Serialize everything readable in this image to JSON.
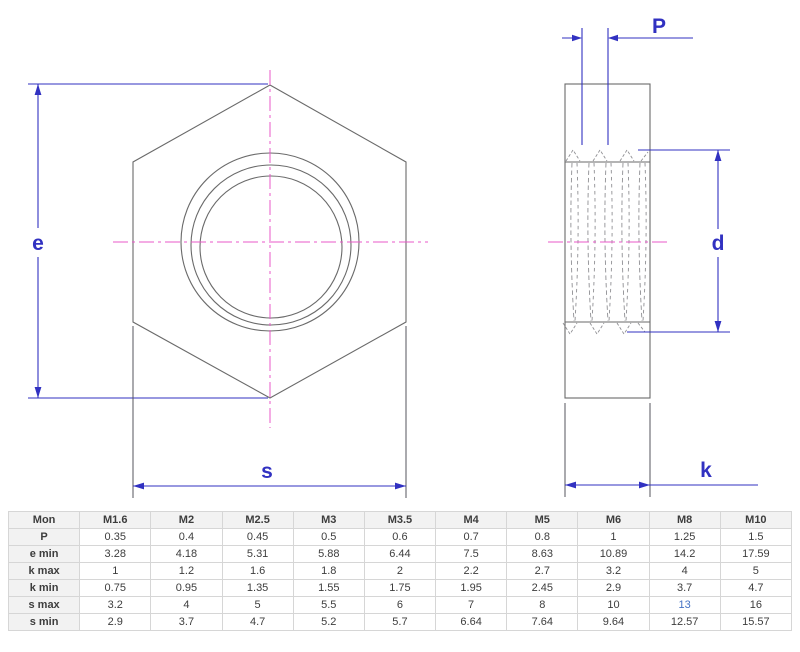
{
  "drawing": {
    "labels": {
      "e": "e",
      "s": "s",
      "P": "P",
      "d": "d",
      "k": "k"
    },
    "colors": {
      "dimension": "#3131c1",
      "centerline": "#e858c8",
      "outline": "#6a6a6a",
      "extension": "#55555e",
      "thread": "#8f8f93",
      "highlight": "#4472c4"
    }
  },
  "table": {
    "header": [
      "Mon",
      "M1.6",
      "M2",
      "M2.5",
      "M3",
      "M3.5",
      "M4",
      "M5",
      "M6",
      "M8",
      "M10"
    ],
    "rows": [
      {
        "label": "P",
        "values": [
          "0.35",
          "0.4",
          "0.45",
          "0.5",
          "0.6",
          "0.7",
          "0.8",
          "1",
          "1.25",
          "1.5"
        ]
      },
      {
        "label": "e min",
        "values": [
          "3.28",
          "4.18",
          "5.31",
          "5.88",
          "6.44",
          "7.5",
          "8.63",
          "10.89",
          "14.2",
          "17.59"
        ]
      },
      {
        "label": "k max",
        "values": [
          "1",
          "1.2",
          "1.6",
          "1.8",
          "2",
          "2.2",
          "2.7",
          "3.2",
          "4",
          "5"
        ]
      },
      {
        "label": "k min",
        "values": [
          "0.75",
          "0.95",
          "1.35",
          "1.55",
          "1.75",
          "1.95",
          "2.45",
          "2.9",
          "3.7",
          "4.7"
        ]
      },
      {
        "label": "s max",
        "values": [
          "3.2",
          "4",
          "5",
          "5.5",
          "6",
          "7",
          "8",
          "10",
          "13",
          "16"
        ]
      },
      {
        "label": "s min",
        "values": [
          "2.9",
          "3.7",
          "4.7",
          "5.2",
          "5.7",
          "6.64",
          "7.64",
          "9.64",
          "12.57",
          "15.57"
        ]
      }
    ],
    "highlight": {
      "row": 4,
      "col": 8
    }
  }
}
